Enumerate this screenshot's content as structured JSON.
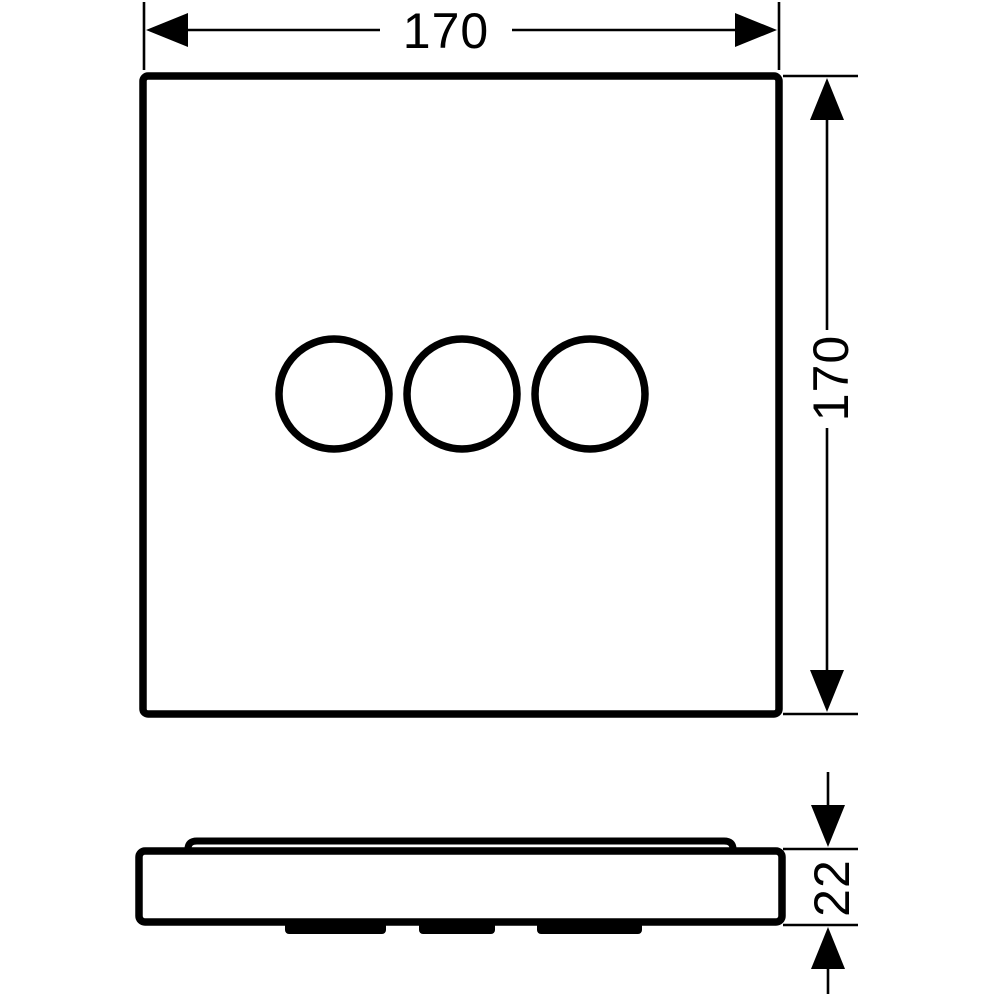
{
  "colors": {
    "line": "#000000",
    "background": "#ffffff"
  },
  "icons": {
    "dimension_arrowhead": "filled-triangle"
  },
  "front_view": {
    "handle_circle_count": 3,
    "width_dimension": {
      "label": "170"
    },
    "height_dimension": {
      "label": "170"
    }
  },
  "side_view": {
    "thickness_dimension": {
      "label": "22"
    }
  }
}
